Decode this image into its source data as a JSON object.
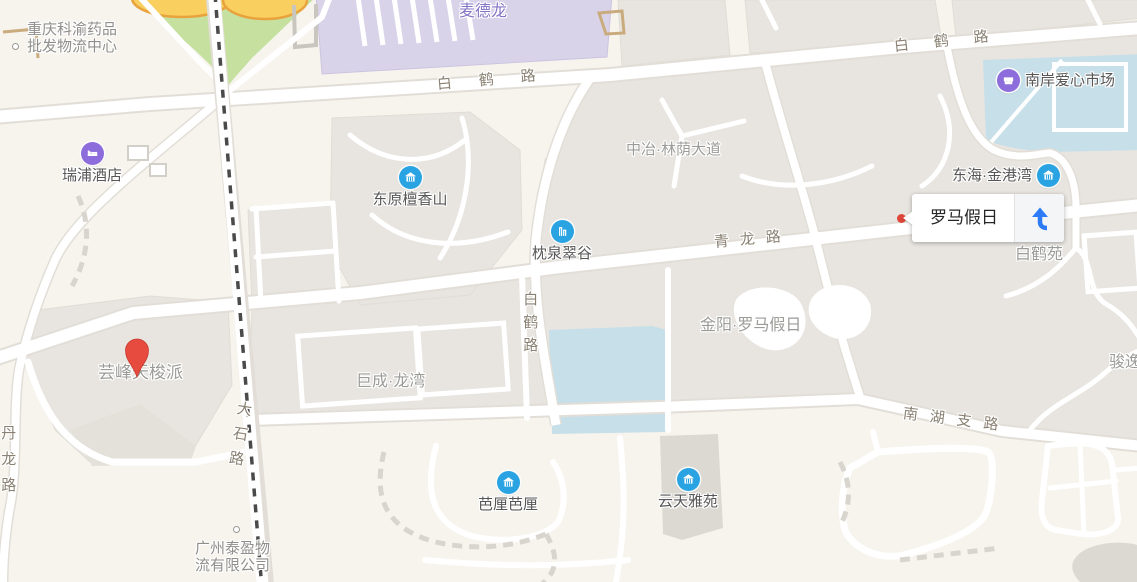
{
  "map": {
    "popup": {
      "title": "罗马假日",
      "action_icon": "navigate-arrow"
    },
    "pois": [
      {
        "text": "瑞浦酒店",
        "icon": "hotel",
        "icon_color": "#8d6cdb"
      },
      {
        "text": "南岸爱心市场",
        "icon": "market",
        "icon_color": "#8d6cdb"
      },
      {
        "text": "东原檀香山",
        "icon": "residence",
        "icon_color": "#29a3e2"
      },
      {
        "text": "枕泉翠谷",
        "icon": "tower",
        "icon_color": "#29a3e2"
      },
      {
        "text": "东海·金港湾",
        "icon": "residence",
        "icon_color": "#29a3e2"
      },
      {
        "text": "芭厘芭厘",
        "icon": "residence",
        "icon_color": "#29a3e2"
      },
      {
        "text": "云天雅苑",
        "icon": "residence",
        "icon_color": "#29a3e2"
      }
    ],
    "area_labels": [
      "中冶·林荫大道",
      "金阳·罗马假日",
      "巨成·龙湾",
      "白鹤苑",
      "芸峰天梭派",
      "骏逸"
    ],
    "store_label": "麦德龙",
    "company_labels": [
      {
        "line1": "重庆科渝药品",
        "line2": "批发物流中心"
      },
      {
        "line1": "广州泰盈物",
        "line2": "流有限公司"
      }
    ],
    "road_labels": [
      {
        "text": "白鹤路"
      },
      {
        "text": "白鹤路"
      },
      {
        "text": "青龙路"
      },
      {
        "text": "白鹤路"
      },
      {
        "text": "大石路"
      },
      {
        "text": "南湖支路"
      },
      {
        "text": "丹龙路"
      }
    ],
    "marker": {
      "type": "red-pin"
    },
    "colors": {
      "land": "#f7f4ee",
      "block": "#e8e5e0",
      "block_dark": "#dcd9d3",
      "road": "#ffffff",
      "road_casing": "#e2ded7",
      "water": "#c6dfe9",
      "park": "#c6e0a0",
      "park_building": "#f9cf5f",
      "park_building_stroke": "#e8a33d",
      "metro_building": "#d8d3e9",
      "railway": "#4a4a4a",
      "poi_blue": "#29a3e2",
      "poi_purple": "#8d6cdb",
      "pin_red": "#e74a3e",
      "popup_arrow_blue": "#2d7bf7",
      "label_area": "#9b9b97",
      "label_road": "#8a8173",
      "label_metro": "#8374c5"
    }
  }
}
